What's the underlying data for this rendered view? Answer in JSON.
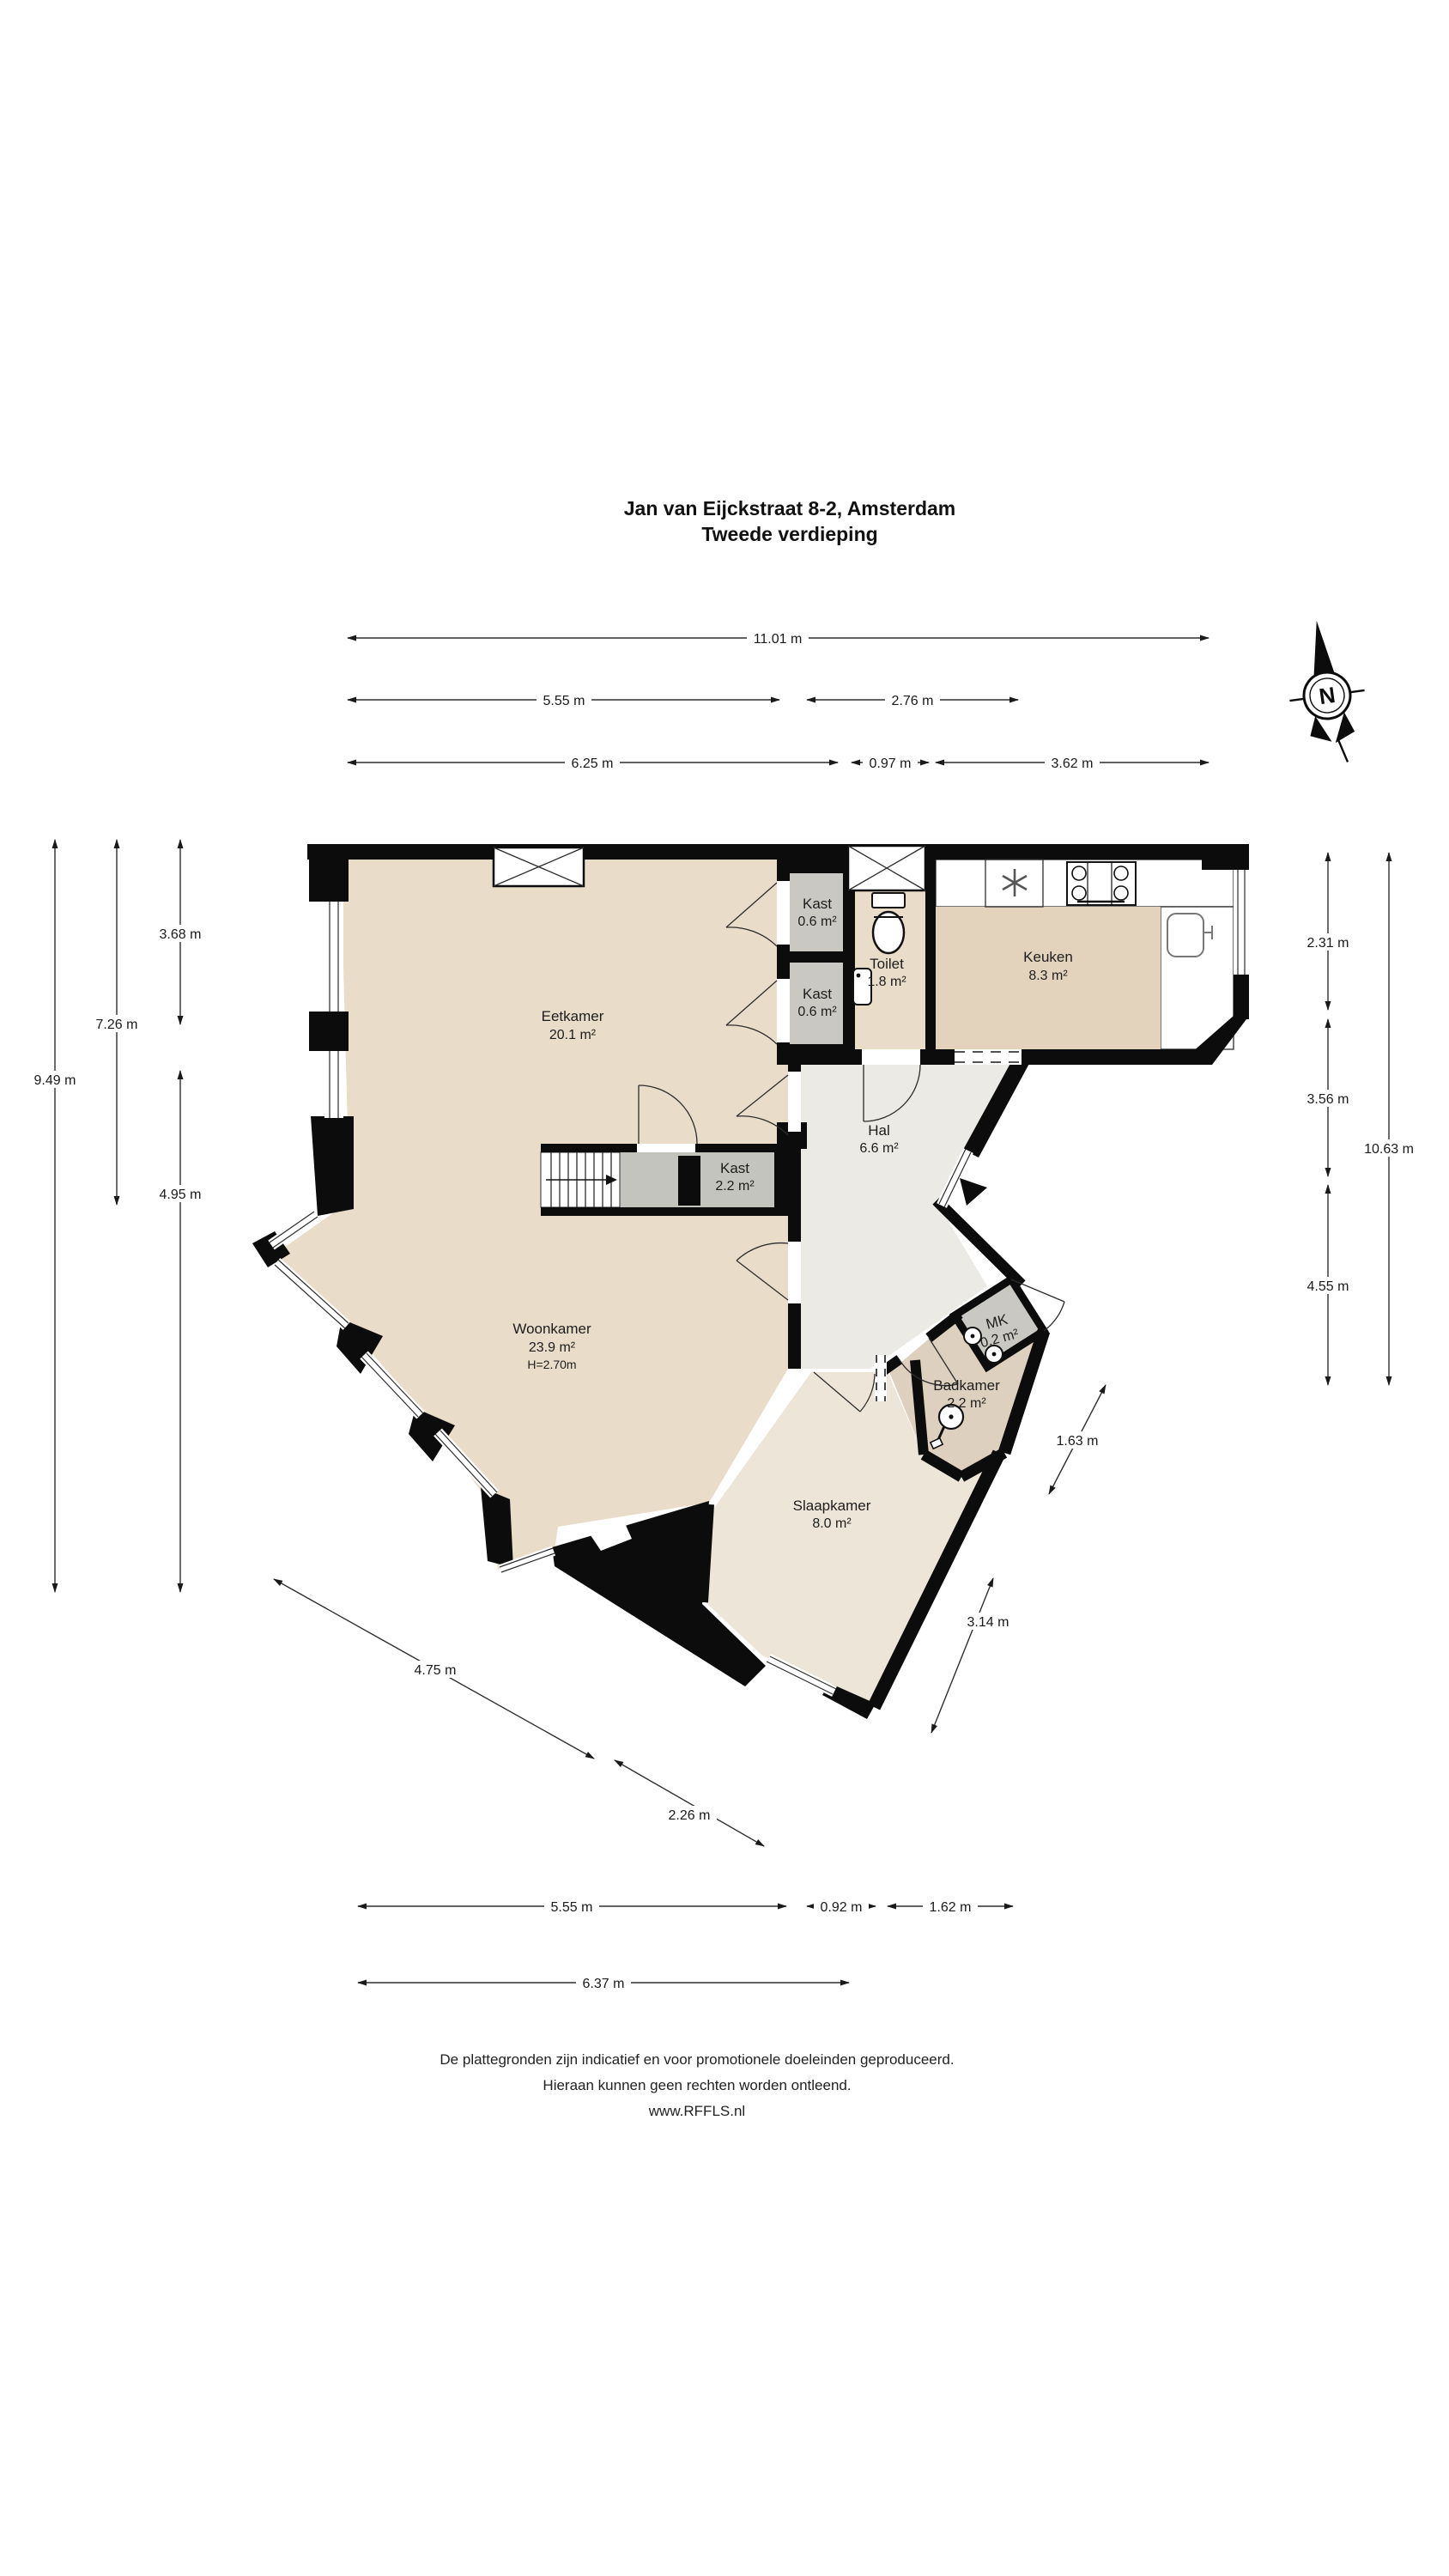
{
  "title": {
    "line1": "Jan van Eijckstraat 8-2, Amsterdam",
    "line2": "Tweede verdieping"
  },
  "compass": {
    "label": "N"
  },
  "rooms": {
    "eetkamer": {
      "name": "Eetkamer",
      "area": "20.1 m²"
    },
    "kast_boven": {
      "name": "Kast",
      "area": "0.6 m²"
    },
    "kast_onder": {
      "name": "Kast",
      "area": "0.6 m²"
    },
    "toilet": {
      "name": "Toilet",
      "area": "1.8 m²"
    },
    "keuken": {
      "name": "Keuken",
      "area": "8.3 m²"
    },
    "hal": {
      "name": "Hal",
      "area": "6.6 m²"
    },
    "kast_trap": {
      "name": "Kast",
      "area": "2.2 m²"
    },
    "woonkamer": {
      "name": "Woonkamer",
      "area": "23.9 m²",
      "height": "H=2.70m"
    },
    "slaapkamer": {
      "name": "Slaapkamer",
      "area": "8.0 m²"
    },
    "badkamer": {
      "name": "Badkamer",
      "area": "2.2 m²"
    },
    "mk": {
      "name": "MK",
      "area": "0.2 m²"
    }
  },
  "dims": {
    "top": [
      {
        "label": "11.01 m"
      },
      {
        "label": "5.55 m"
      },
      {
        "label": "2.76 m"
      },
      {
        "label": "6.25 m"
      },
      {
        "label": "0.97 m"
      },
      {
        "label": "3.62 m"
      }
    ],
    "left": [
      {
        "label": "3.68 m"
      },
      {
        "label": "7.26 m"
      },
      {
        "label": "9.49 m"
      },
      {
        "label": "4.95 m"
      }
    ],
    "right": [
      {
        "label": "2.31 m"
      },
      {
        "label": "3.56 m"
      },
      {
        "label": "4.55 m"
      },
      {
        "label": "10.63 m"
      }
    ],
    "diagonal": [
      {
        "label": "1.63 m"
      },
      {
        "label": "3.14 m"
      },
      {
        "label": "4.75 m"
      },
      {
        "label": "2.26 m"
      }
    ],
    "bottom": [
      {
        "label": "5.55 m"
      },
      {
        "label": "0.92 m"
      },
      {
        "label": "1.62 m"
      },
      {
        "label": "6.37 m"
      }
    ]
  },
  "footer": {
    "line1": "De plattegronden zijn indicatief en voor promotionele doeleinden geproduceerd.",
    "line2": "Hieraan kunnen geen rechten worden ontleend.",
    "line3": "www.RFFLS.nl"
  },
  "colors": {
    "floor_living": "#e9dcc8",
    "floor_kitchen": "#e3d3bd",
    "floor_bath": "#ded0bf",
    "floor_bedroom": "#ede6d8",
    "floor_hall": "#eceae5",
    "floor_closet": "#c9c8c2",
    "wall": "#0c0c0c"
  }
}
